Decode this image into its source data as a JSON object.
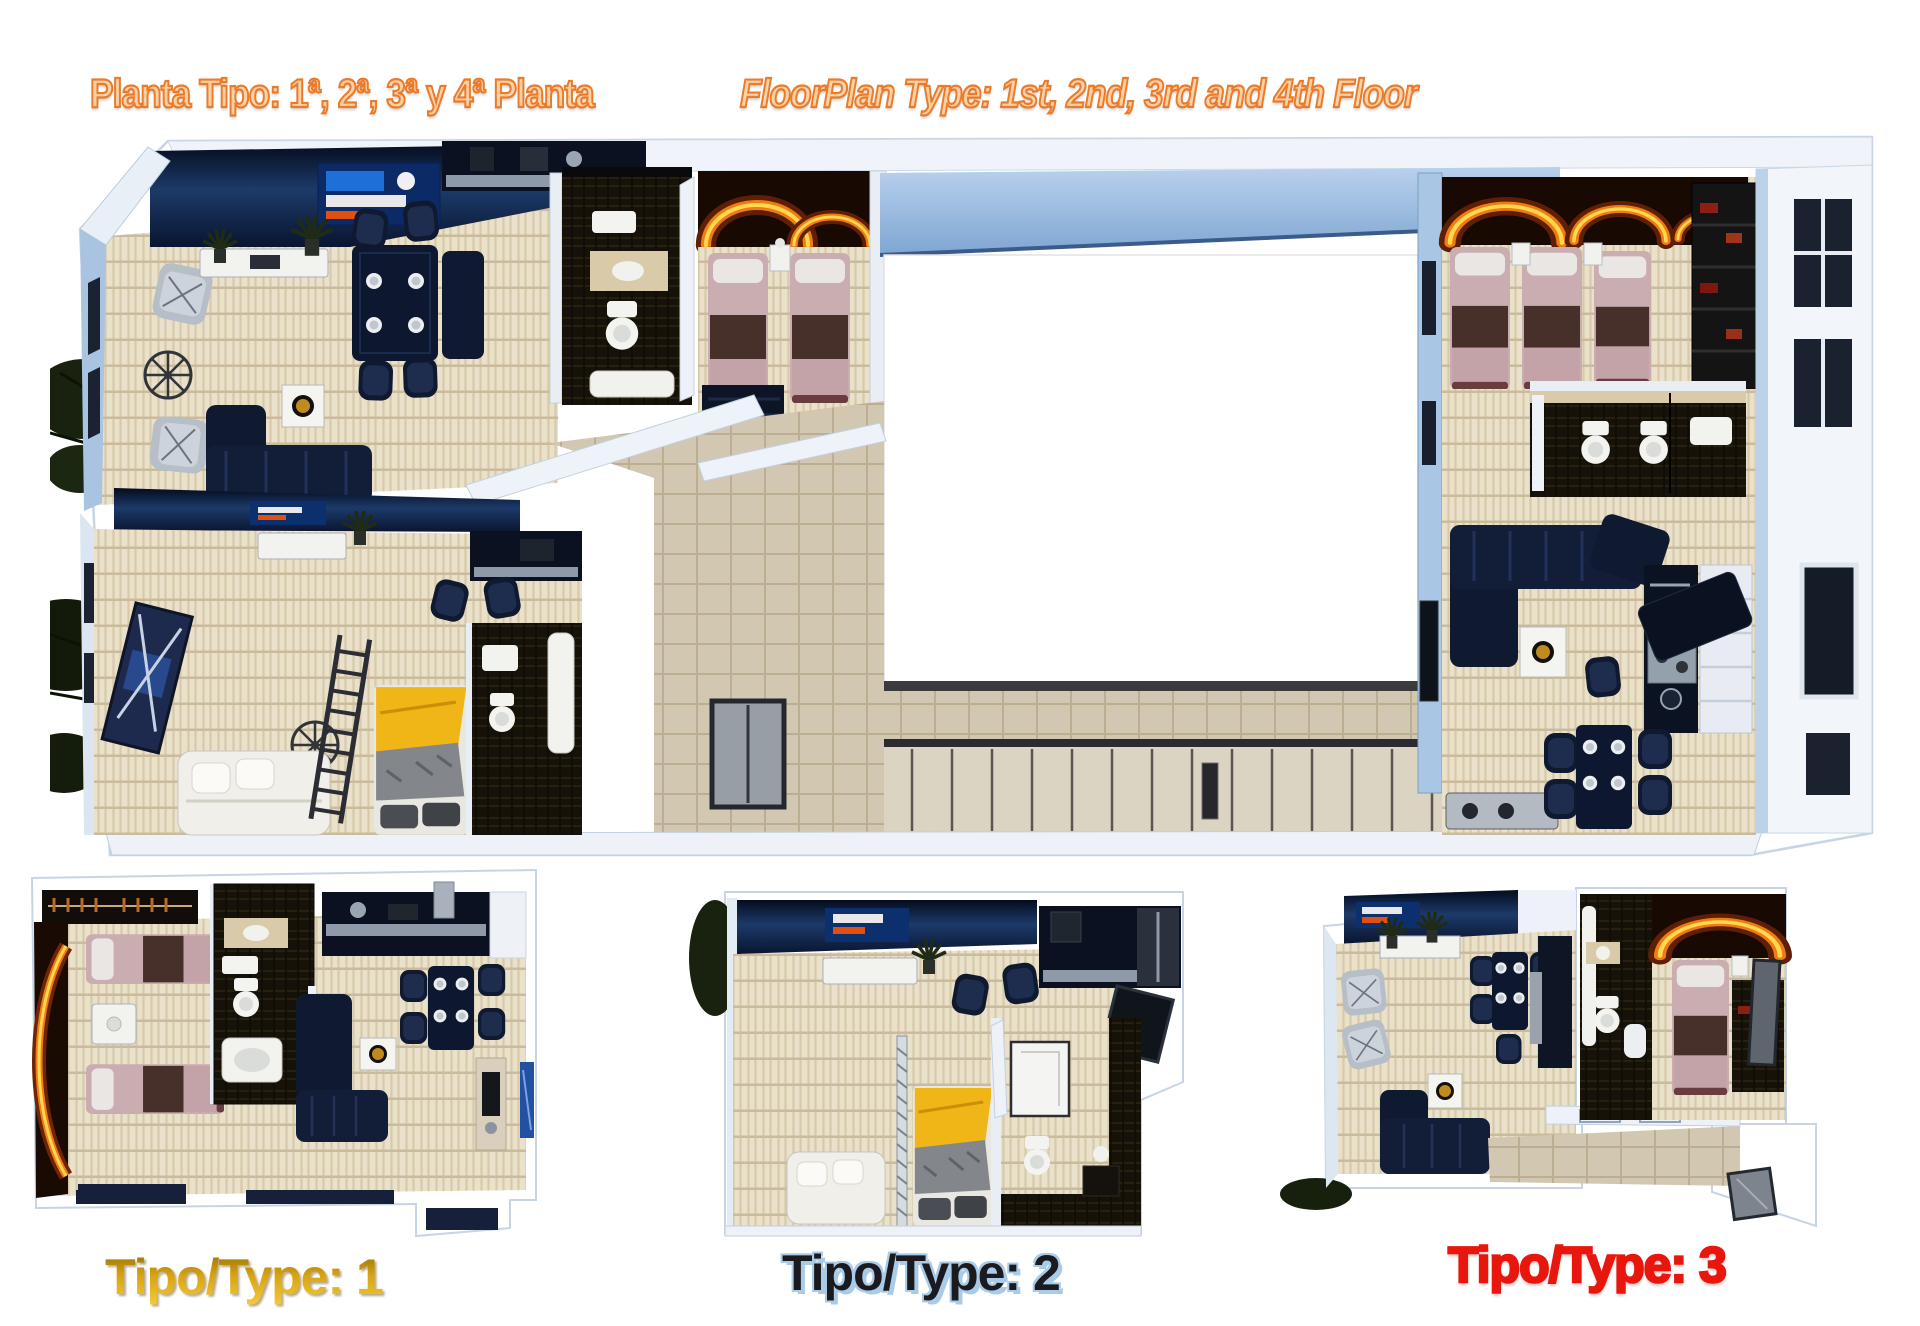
{
  "header": {
    "title_left": "Planta Tipo: 1ª, 2ª, 3ª y 4ª Planta",
    "title_right": "FloorPlan Type: 1st, 2nd, 3rd and 4th Floor"
  },
  "plan_labels": {
    "type1": {
      "text": "Tipo/Type: 1"
    },
    "type2": {
      "text": "Tipo/Type: 2"
    },
    "type3": {
      "text": "Tipo/Type: 3"
    }
  },
  "colors": {
    "title_fill": "#FCD1A5",
    "title_outline": "#EA7B2B",
    "label1_gold": "#D8A413",
    "label1_gold_light": "#F2CC3C",
    "label1_gold_dark": "#8F6A02",
    "label2_ink": "#1B1B1F",
    "label2_halo": "#A9CBE8",
    "label3_red": "#E8160C",
    "floor_beige": "#EAE1CB",
    "wall_blue": "#A9C6E4",
    "furniture_navy": "#101C36",
    "bed_pink": "#C9ADB0",
    "bed_yellow": "#F0B517",
    "fire_orange": "#EF7D13"
  }
}
